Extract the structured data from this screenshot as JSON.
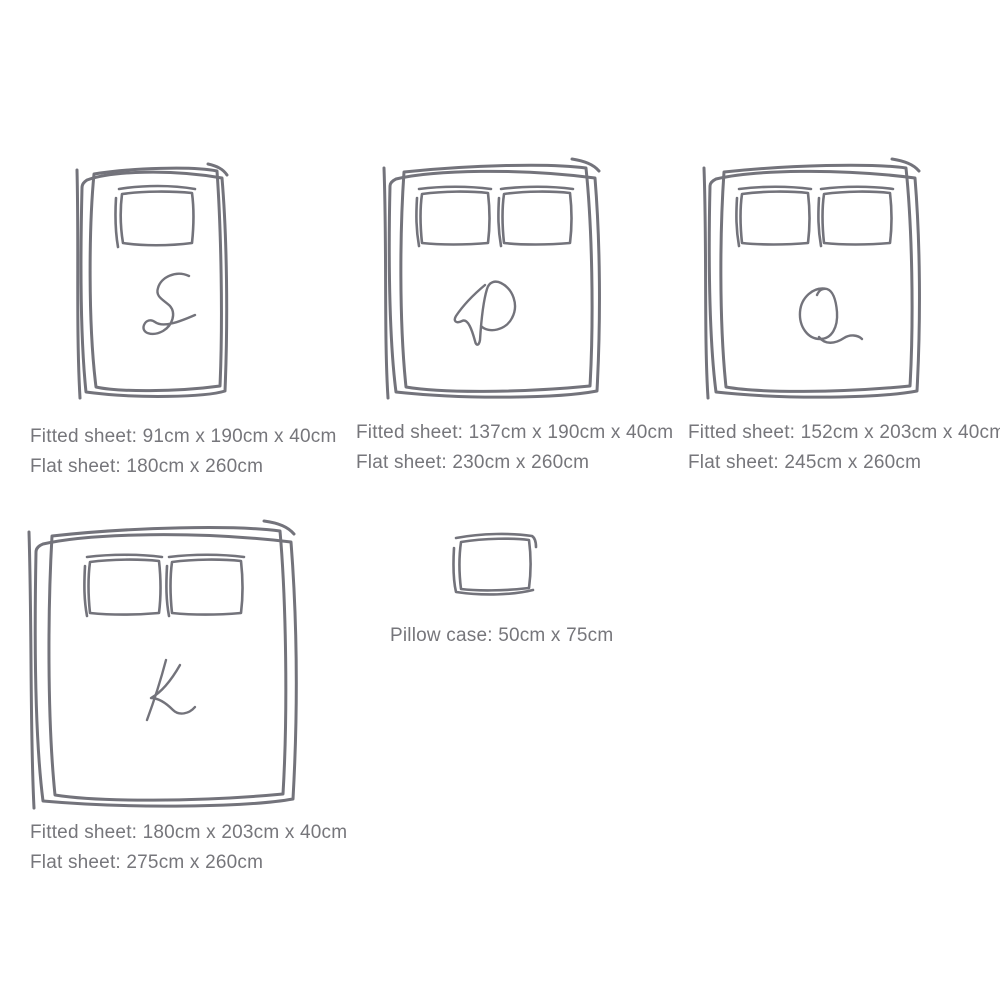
{
  "palette": {
    "line": "#73737b",
    "text": "#76767b",
    "background": "#ffffff"
  },
  "sizes": [
    {
      "code": "S",
      "fitted": "Fitted sheet: 91cm x 190cm x 40cm",
      "flat": "Flat sheet: 180cm x 260cm"
    },
    {
      "code": "D",
      "fitted": "Fitted sheet: 137cm x 190cm x 40cm",
      "flat": "Flat sheet: 230cm x 260cm"
    },
    {
      "code": "Q",
      "fitted": "Fitted sheet: 152cm x 203cm x 40cm",
      "flat": "Flat sheet: 245cm x 260cm"
    },
    {
      "code": "K",
      "fitted": "Fitted sheet: 180cm x 203cm x 40cm",
      "flat": "Flat sheet: 275cm x 260cm"
    }
  ],
  "pillow": {
    "label": "Pillow case: 50cm x 75cm"
  }
}
